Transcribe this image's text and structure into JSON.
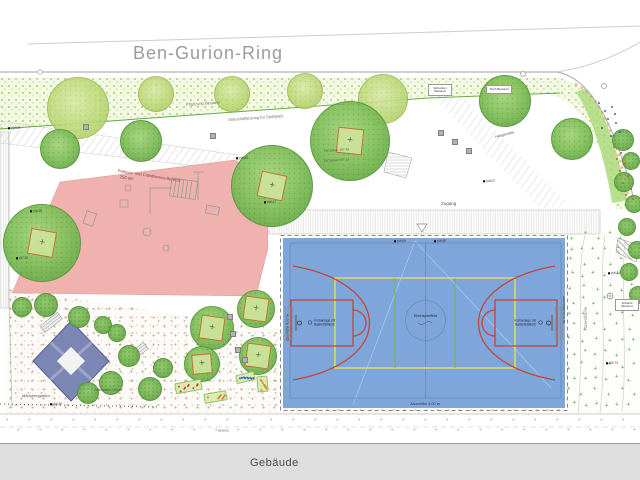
{
  "street_name": "Ben-Gurion-Ring",
  "building_label": "Gebäude",
  "areas": {
    "planting": "Pflanzung Bestand",
    "shrubs": "Strauchpflanzung für Spielplatz",
    "parkour_1": "Parkour- und Calisthenics-Bereich",
    "parkour_2": "250 qm",
    "girls_garden": "Mädchengarten",
    "lawn": "Rasenfläche",
    "meadow": "Wiese",
    "hammock": "Hängematte",
    "access": "Zugang",
    "fence_low": "Zaunhöhe 2,00 m",
    "wall_1": "OK Mauer 157,45",
    "wall_2": "OK Mauer 157,11",
    "box_steps": "Sitzstufen Bestand",
    "box_table": "Tisch Bestand",
    "box_shaft": "Schacht Bestand"
  },
  "court": {
    "center_label": "Kleinspielfeld",
    "hoop_line1": "Korbanlage mit",
    "hoop_line2": "Basketballkorb",
    "fence_label": "Zaunhöhe 4,00 m",
    "fill": "#7ea6da",
    "line_red": "#c4453a",
    "line_yellow": "#e6e24e",
    "line_green": "#79b34c"
  },
  "colors": {
    "pink_area": "#f0b2ae",
    "diamond": "#7b86b4",
    "building": "#dedede",
    "tree_dark": "#7dbd58",
    "tree_light": "#c3dc81",
    "curb_orange": "#e0945a"
  },
  "spot_elevations": [
    {
      "x": 30,
      "y": 209,
      "t": "158,36"
    },
    {
      "x": 16,
      "y": 256,
      "t": "157,32"
    },
    {
      "x": 236,
      "y": 156,
      "t": "156,43"
    },
    {
      "x": 264,
      "y": 200,
      "t": "156,27"
    },
    {
      "x": 394,
      "y": 239,
      "t": "156,64"
    },
    {
      "x": 434,
      "y": 239,
      "t": "156,68"
    },
    {
      "x": 608,
      "y": 271,
      "t": "156,74"
    },
    {
      "x": 606,
      "y": 361,
      "t": "155,74"
    },
    {
      "x": 50,
      "y": 402,
      "t": "158,26"
    },
    {
      "x": 483,
      "y": 179,
      "t": "158,07"
    },
    {
      "x": 8,
      "y": 126,
      "t": "158,06"
    }
  ],
  "trees_light": [
    [
      78,
      108,
      31
    ],
    [
      156,
      94,
      18
    ],
    [
      232,
      94,
      18
    ],
    [
      305,
      91,
      18
    ],
    [
      383,
      99,
      25
    ]
  ],
  "trees_dark": [
    [
      60,
      149,
      20,
      0,
      0
    ],
    [
      141,
      141,
      21,
      0,
      0
    ],
    [
      272,
      186,
      41,
      26,
      12
    ],
    [
      350,
      141,
      40,
      26,
      6
    ],
    [
      42,
      243,
      39,
      26,
      10
    ],
    [
      505,
      101,
      26,
      0,
      0
    ],
    [
      572,
      139,
      21,
      0,
      0
    ],
    [
      212,
      328,
      22,
      24,
      8
    ],
    [
      256,
      309,
      19,
      24,
      8
    ],
    [
      258,
      356,
      19,
      24,
      8
    ],
    [
      202,
      364,
      18,
      20,
      -5
    ]
  ],
  "bushes": [
    [
      22,
      307,
      10
    ],
    [
      46,
      305,
      12
    ],
    [
      79,
      317,
      11
    ],
    [
      103,
      325,
      9
    ],
    [
      117,
      333,
      9
    ],
    [
      129,
      356,
      11
    ],
    [
      111,
      383,
      12
    ],
    [
      88,
      393,
      11
    ],
    [
      150,
      389,
      12
    ],
    [
      163,
      368,
      10
    ],
    [
      623,
      140,
      11
    ],
    [
      631,
      161,
      9
    ],
    [
      624,
      182,
      10
    ],
    [
      634,
      204,
      9
    ],
    [
      627,
      227,
      9
    ],
    [
      637,
      250,
      9
    ],
    [
      629,
      272,
      9
    ],
    [
      638,
      295,
      9
    ]
  ],
  "seat_cubes": [
    [
      86,
      127
    ],
    [
      213,
      136
    ],
    [
      441,
      133
    ],
    [
      455,
      142
    ],
    [
      469,
      151
    ],
    [
      230,
      317
    ],
    [
      233,
      334
    ],
    [
      238,
      350
    ],
    [
      245,
      360
    ]
  ],
  "flower_dots": {
    "blue": [
      [
        598,
        102
      ],
      [
        604,
        110
      ],
      [
        611,
        106
      ],
      [
        607,
        118
      ],
      [
        615,
        122
      ],
      [
        601,
        127
      ],
      [
        619,
        131
      ],
      [
        610,
        135
      ],
      [
        614,
        113
      ]
    ],
    "warm": [
      [
        613,
        146
      ],
      [
        620,
        152
      ],
      [
        616,
        158
      ],
      [
        624,
        163
      ],
      [
        619,
        170
      ],
      [
        627,
        175
      ],
      [
        622,
        182
      ],
      [
        630,
        188
      ],
      [
        625,
        194
      ],
      [
        632,
        198
      ]
    ]
  },
  "beds": [
    {
      "x": 175,
      "y": 381,
      "w": 27,
      "h": 11,
      "rot": -10,
      "c": "#cc4030"
    },
    {
      "x": 204,
      "y": 392,
      "w": 23,
      "h": 10,
      "rot": -10,
      "c": "#e08030"
    },
    {
      "x": 236,
      "y": 373,
      "w": 19,
      "h": 9,
      "rot": -14,
      "c": "#4060c8"
    },
    {
      "x": 257,
      "y": 376,
      "w": 11,
      "h": 16,
      "rot": -5,
      "c": "#e08030"
    }
  ]
}
